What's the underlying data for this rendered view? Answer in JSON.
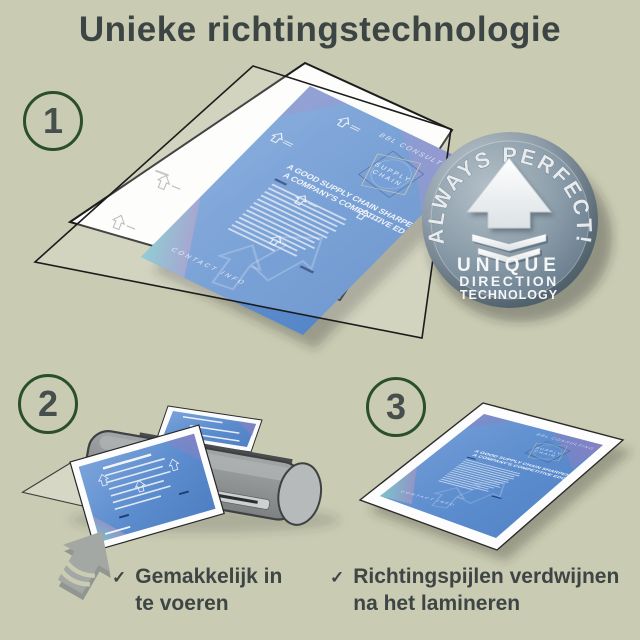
{
  "title": "Unieke richtingstechnologie",
  "steps": [
    {
      "number": "1"
    },
    {
      "number": "2"
    },
    {
      "number": "3"
    }
  ],
  "badge": {
    "arc_text": "ALWAYS PERFECT!",
    "line1": "UNIQUE",
    "line2": "DIRECTION",
    "line3": "TECHNOLOGY"
  },
  "document": {
    "company": "BBL CONSULTING",
    "logo_top": "SUPPLY",
    "logo_bottom": "CHAIN",
    "headline1": "A GOOD SUPPLY CHAIN SHARPENS",
    "headline2": "A COMPANY'S COMPETITIVE EDGE.",
    "footer": "CONTACT INFO"
  },
  "bullets": [
    {
      "mark": "✓",
      "line1": "Gemakkelijk in",
      "line2": "te voeren"
    },
    {
      "mark": "✓",
      "line1": "Richtingspijlen verdwijnen",
      "line2": "na het lamineren"
    }
  ],
  "colors": {
    "background": "#c9cbb2",
    "heading_text": "#3d4544",
    "step_circle_green": "#2c4f2b",
    "document_blue": "#5b8ccd",
    "badge_steel": "#7d909f",
    "laminator_gray": "#8a8e8f"
  }
}
